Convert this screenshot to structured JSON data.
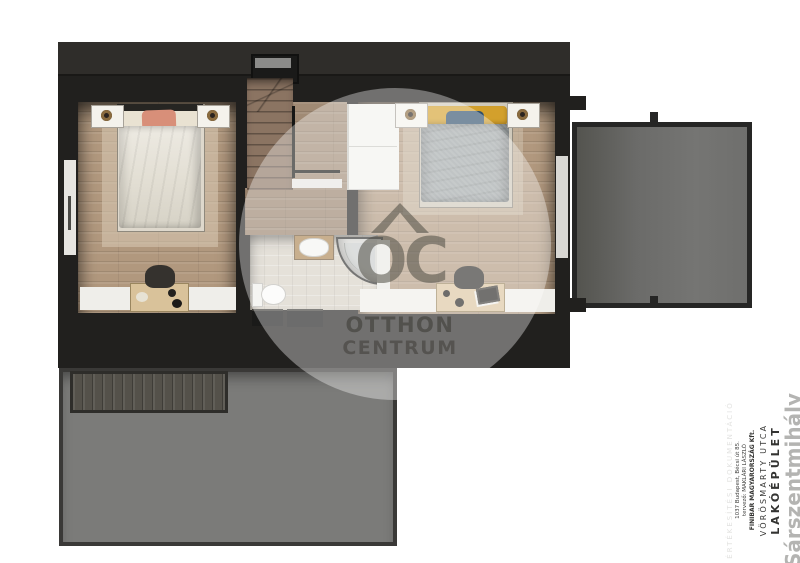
{
  "scene": {
    "kind": "3d-floor-plan-render",
    "floor": "upper-floor",
    "rooms": [
      {
        "name": "bedroom-left",
        "features": [
          "double-bed",
          "two-nightstands",
          "two-lamps",
          "desk",
          "chair",
          "rug",
          "window-band"
        ]
      },
      {
        "name": "bedroom-right",
        "features": [
          "double-bed",
          "two-nightstands",
          "two-lamps",
          "desk",
          "chair",
          "rug",
          "window-band",
          "balcony-door"
        ]
      },
      {
        "name": "bathroom",
        "features": [
          "toilet",
          "washbasin",
          "corner-shower",
          "tiled-floor"
        ]
      },
      {
        "name": "staircase",
        "features": [
          "winder-steps",
          "railing",
          "half-wall",
          "roof-window"
        ]
      },
      {
        "name": "landing",
        "features": [
          "wardrobe"
        ]
      },
      {
        "name": "balcony-terrace",
        "features": [
          "railing-posts"
        ]
      },
      {
        "name": "lower-roof",
        "features": [
          "pergola-strip"
        ]
      }
    ]
  },
  "watermark": {
    "monogram": "OC",
    "line1": "OTTHON",
    "line2": "CENTRUM",
    "logo_icon": "house-roof-icon"
  },
  "title_block": {
    "doc_type": "ÉRTÉKESÍTÉSI DOKUMENTÁCIÓ",
    "address": "1037 Budapest, Bécsi út 85.",
    "designer": "tervező: MAKLÁRI LÁSZLÓ",
    "company": "FINIBAR MAGYARORSZÁG Kft.",
    "street": "VÖRÖSMARTY UTCA",
    "building": "LAKÓÉPÜLET",
    "project": "Sárszentmihály"
  },
  "colors": {
    "background": "#ffffff",
    "wall_dark": "#21201e",
    "roof_band": "#2f2d2a",
    "wood_floor": "#b1987e",
    "stair_wood": "#8b7462",
    "bathroom_tile": "#d6d0c4",
    "lower_roof_gray": "#7b7b79",
    "balcony_gray": "#6f6f6d",
    "white_furniture": "#f3f2ee",
    "accent_salmon": "#d88f79",
    "accent_yellow": "#d3a02c",
    "accent_blue": "#2f4f6b",
    "duvet_gray": "#9da3a4",
    "watermark_gray": "rgba(78,76,68,0.55)",
    "title_gray": "#b4b4b2"
  }
}
